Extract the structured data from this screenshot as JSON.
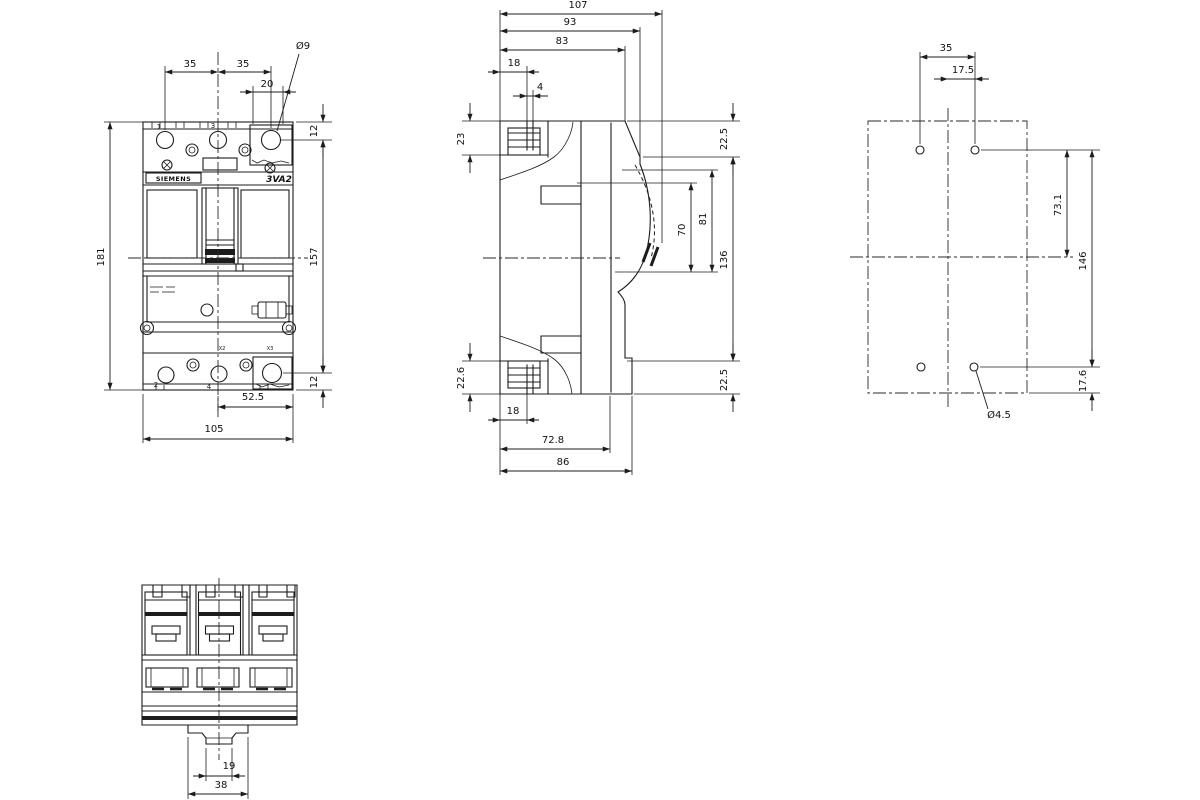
{
  "drawing": {
    "brand": "SIEMENS",
    "model": "3VA2",
    "views": {
      "front": {
        "dims": {
          "pole_pitch_left": "35",
          "pole_pitch_right": "35",
          "lug_window": "20",
          "hole_dia": "Ø9",
          "top_offset": "12",
          "total_height": "181",
          "mount_height": "157",
          "bottom_offset": "12",
          "half_width": "52.5",
          "total_width": "105"
        },
        "labels": {
          "terminal1": "1",
          "terminal3": "3",
          "terminal2": "2",
          "terminal4": "4",
          "aux_x2": "X2",
          "aux_x3": "X3"
        }
      },
      "side": {
        "dims": {
          "total_depth": "107",
          "handle_depth": "93",
          "front_depth": "83",
          "clamp_top": "18",
          "slot_top": "4",
          "top_left": "23",
          "top_right": "22.5",
          "handle_sweep_inner": "70",
          "handle_sweep_outer": "81",
          "mid_height": "136",
          "bottom_left": "22.6",
          "bottom_right": "22.5",
          "clamp_bottom": "18",
          "base_depth": "72.8",
          "mount_depth": "86"
        }
      },
      "back": {
        "dims": {
          "hole_pitch": "35",
          "half_pitch": "17.5",
          "upper_hole_span": "73.1",
          "hole_span": "146",
          "bottom_offset": "17.6",
          "hole_dia": "Ø4.5"
        }
      },
      "bottom": {
        "dims": {
          "clip_width": "19",
          "foot_width": "38"
        }
      }
    }
  }
}
